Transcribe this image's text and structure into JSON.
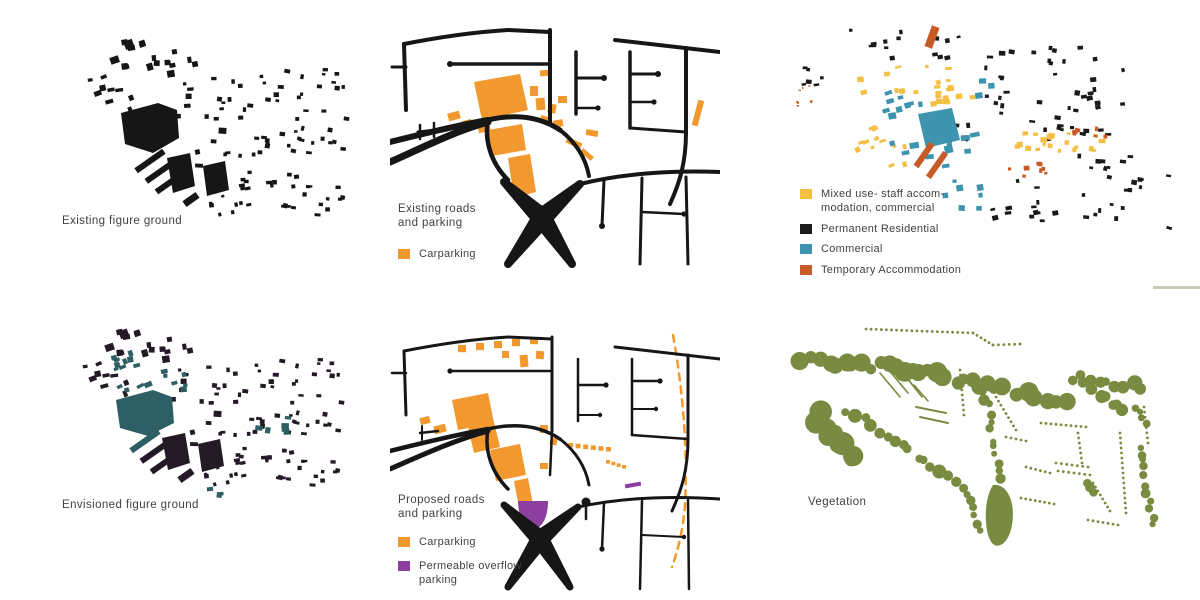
{
  "page": {
    "background": "#ffffff"
  },
  "colors": {
    "ink": "#161616",
    "label_text": "#414141",
    "carparking": "#F1992E",
    "mixed_use": "#F4C044",
    "permanent_residential": "#1a1a1a",
    "commercial": "#3E93AF",
    "temporary_accommodation": "#C65B28",
    "permeable_parking": "#8C3F9E",
    "vegetation": "#7A8A40",
    "envisioned_existing": "#231A25",
    "envisioned_new": "#2E5F64",
    "faint_dash": "#C9CCB9"
  },
  "panels": {
    "existing_figure_ground": {
      "label": "Existing  figure ground"
    },
    "existing_roads": {
      "label": "Existing roads\nand parking",
      "legend": [
        {
          "label": "Carparking"
        }
      ]
    },
    "land_use": {
      "legend": [
        {
          "label": "Mixed use- staff accom-\nmodation, commercial"
        },
        {
          "label": "Permanent Residential"
        },
        {
          "label": "Commercial"
        },
        {
          "label": "Temporary Accommodation"
        }
      ]
    },
    "envisioned_figure_ground": {
      "label": "Envisioned figure ground"
    },
    "proposed_roads": {
      "label": "Proposed roads\nand parking",
      "legend": [
        {
          "label": "Carparking"
        },
        {
          "label": "Permeable overflow\nparking"
        }
      ]
    },
    "vegetation": {
      "label": "Vegetation"
    }
  }
}
